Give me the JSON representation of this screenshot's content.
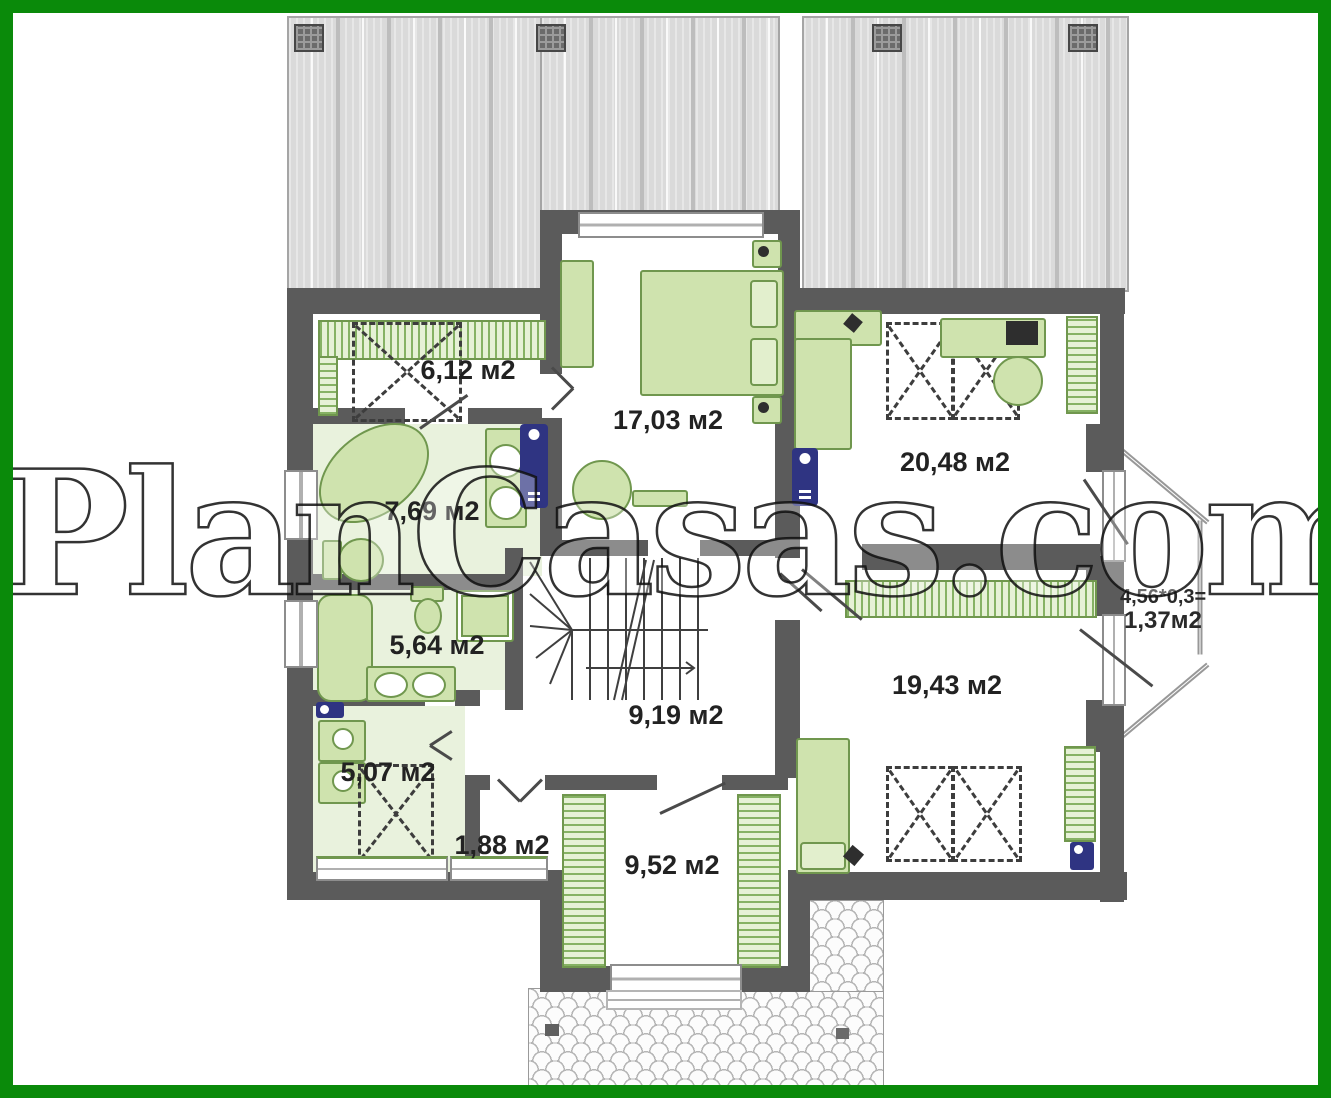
{
  "watermark": "PlanCasas.com",
  "plan": {
    "rooms": [
      {
        "name": "wardrobe-top-left",
        "area": "6,12 м2"
      },
      {
        "name": "bedroom-top-center",
        "area": "17,03 м2"
      },
      {
        "name": "bedroom-top-right",
        "area": "20,48 м2"
      },
      {
        "name": "bathroom-upper",
        "area": "7,69 м2"
      },
      {
        "name": "bathroom-lower",
        "area": "5,64 м2"
      },
      {
        "name": "utility-room",
        "area": "5,07 м2"
      },
      {
        "name": "closet-small",
        "area": "1,88 м2"
      },
      {
        "name": "stair-hall",
        "area": "9,19 м2"
      },
      {
        "name": "bedroom-bottom-right",
        "area": "19,43 м2"
      },
      {
        "name": "dressing-bottom",
        "area": "9,52 м2"
      },
      {
        "name": "balcony",
        "calc": "4,56*0,3=",
        "area": "1,37м2"
      }
    ],
    "colors": {
      "frame_green": "#0a8a0a",
      "wall_gray": "#5b5b5b",
      "furniture_green": "#cfe3ae",
      "radiator_navy": "#2f3482",
      "roof_gray": "#dadada"
    }
  }
}
